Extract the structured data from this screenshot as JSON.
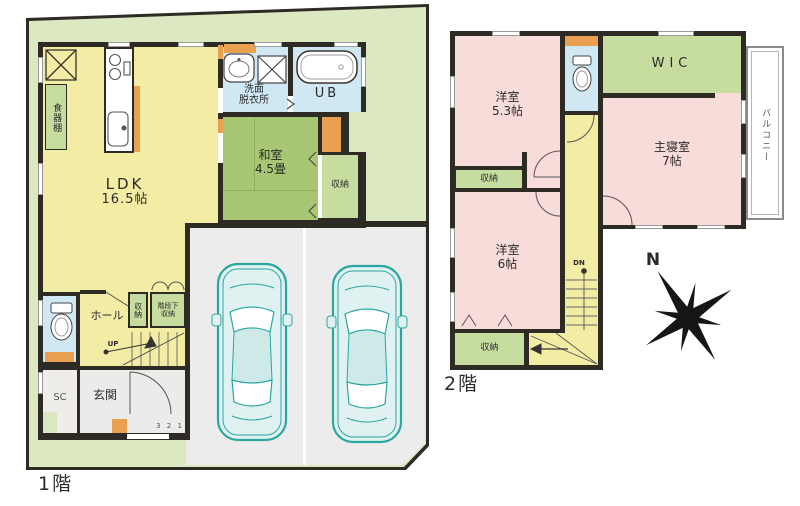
{
  "floor1": {
    "floor_label": "1階",
    "ldk_name": "LDK",
    "ldk_size": "16.5帖",
    "dish_shelf": "食器棚",
    "washroom_line1": "洗面",
    "washroom_line2": "脱衣所",
    "bath": "UB",
    "washitsu_name": "和室",
    "washitsu_size": "4.5畳",
    "washitsu_closet": "収納",
    "hall": "ホール",
    "hall_closet": "収納",
    "understairs_line1": "階段下",
    "understairs_line2": "収納",
    "up_label": "UP",
    "entrance": "玄関",
    "shoe_closet": "SC",
    "entry_steps": "3 2 1"
  },
  "floor2": {
    "floor_label": "2階",
    "room53_name": "洋室",
    "room53_size": "5.3帖",
    "closet_mid": "収納",
    "room6_name": "洋室",
    "room6_size": "6帖",
    "closet_bottom": "収納",
    "wic": "WIC",
    "master_name": "主寝室",
    "master_size": "7帖",
    "balcony": "バルコニー",
    "dn_label": "DN",
    "compass_north": "N"
  },
  "colors": {
    "site_green": "#dce8c2",
    "wall_dark": "#2e2a24",
    "floor_yellow": "#f3eca5",
    "tatami_green": "#a9c674",
    "closet_green": "#c7dda0",
    "wet_blue": "#cfe8f3",
    "room_pink": "#f7dcda",
    "garage_gray": "#ececec",
    "accent_orange": "#e9a050",
    "car_teal": "#2ba7a2"
  }
}
